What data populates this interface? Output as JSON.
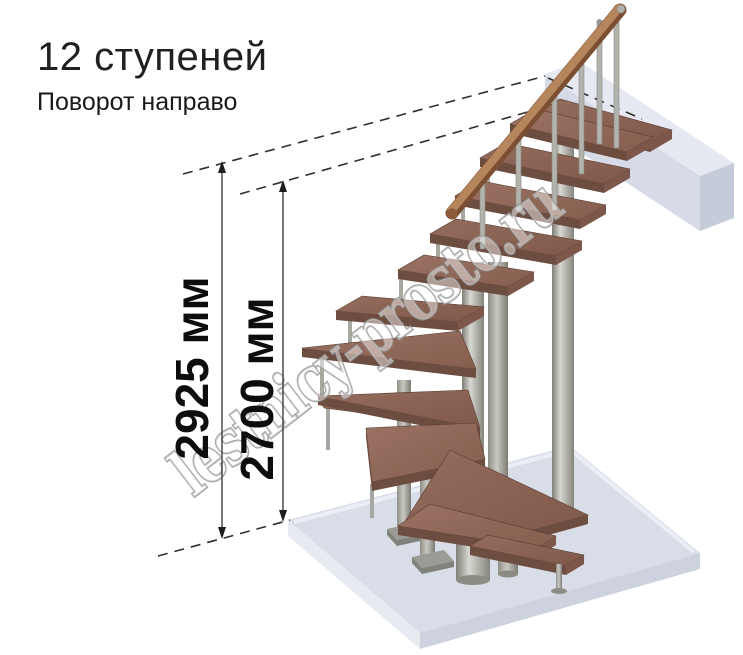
{
  "header": {
    "title": "12 ступеней",
    "subtitle": "Поворот направо"
  },
  "dimensions": {
    "overall_height": "2925 мм",
    "floor_to_ceiling": "2700 мм"
  },
  "watermark": {
    "text": "lestnicy-prosto.ru"
  },
  "staircase": {
    "steps_count": 12,
    "turn_direction": "направо",
    "type": "модульная лестница с поворотом",
    "colors": {
      "tread_top": "#926b5c",
      "tread_front": "#6e4d41",
      "handrail": "#a9714b",
      "metal": "#a6a6a0",
      "floor_slab": "#d9dde8",
      "upper_floor_slab": "#dde1ea",
      "dimension_text": "#0d0d0d",
      "background": "#ffffff"
    }
  }
}
